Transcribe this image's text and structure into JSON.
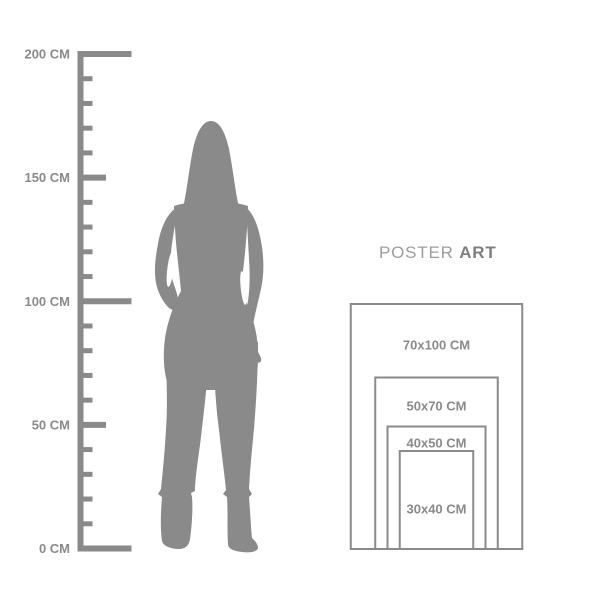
{
  "title": {
    "regular": "POSTER",
    "bold": "ART"
  },
  "ruler": {
    "unit": "CM",
    "max_cm": 200,
    "minor_step_cm": 10,
    "medium_step_cm": 50,
    "major_step_cm": 100,
    "label_values_cm": [
      200,
      150,
      100,
      50,
      0
    ],
    "unit_labels": [
      "200 CM",
      "150 CM",
      "100 CM",
      "50 CM",
      "0 CM"
    ]
  },
  "figure": {
    "name": "woman-silhouette"
  },
  "posters": [
    {
      "label": "70x100 CM",
      "width_cm": 70,
      "height_cm": 100
    },
    {
      "label": "50x70 CM",
      "width_cm": 50,
      "height_cm": 70
    },
    {
      "label": "40x50 CM",
      "width_cm": 40,
      "height_cm": 50
    },
    {
      "label": "30x40 CM",
      "width_cm": 30,
      "height_cm": 40
    }
  ],
  "colors": {
    "background": "#ffffff",
    "figure": "#8a8a8a",
    "ruler": "#8a8a8a",
    "ruler_label_text": "#8a8a8a",
    "poster_border": "#8a8a8a",
    "poster_label_text": "#8a8a8a",
    "title_regular": "#9d9d9d",
    "title_bold": "#7e7e7e"
  }
}
